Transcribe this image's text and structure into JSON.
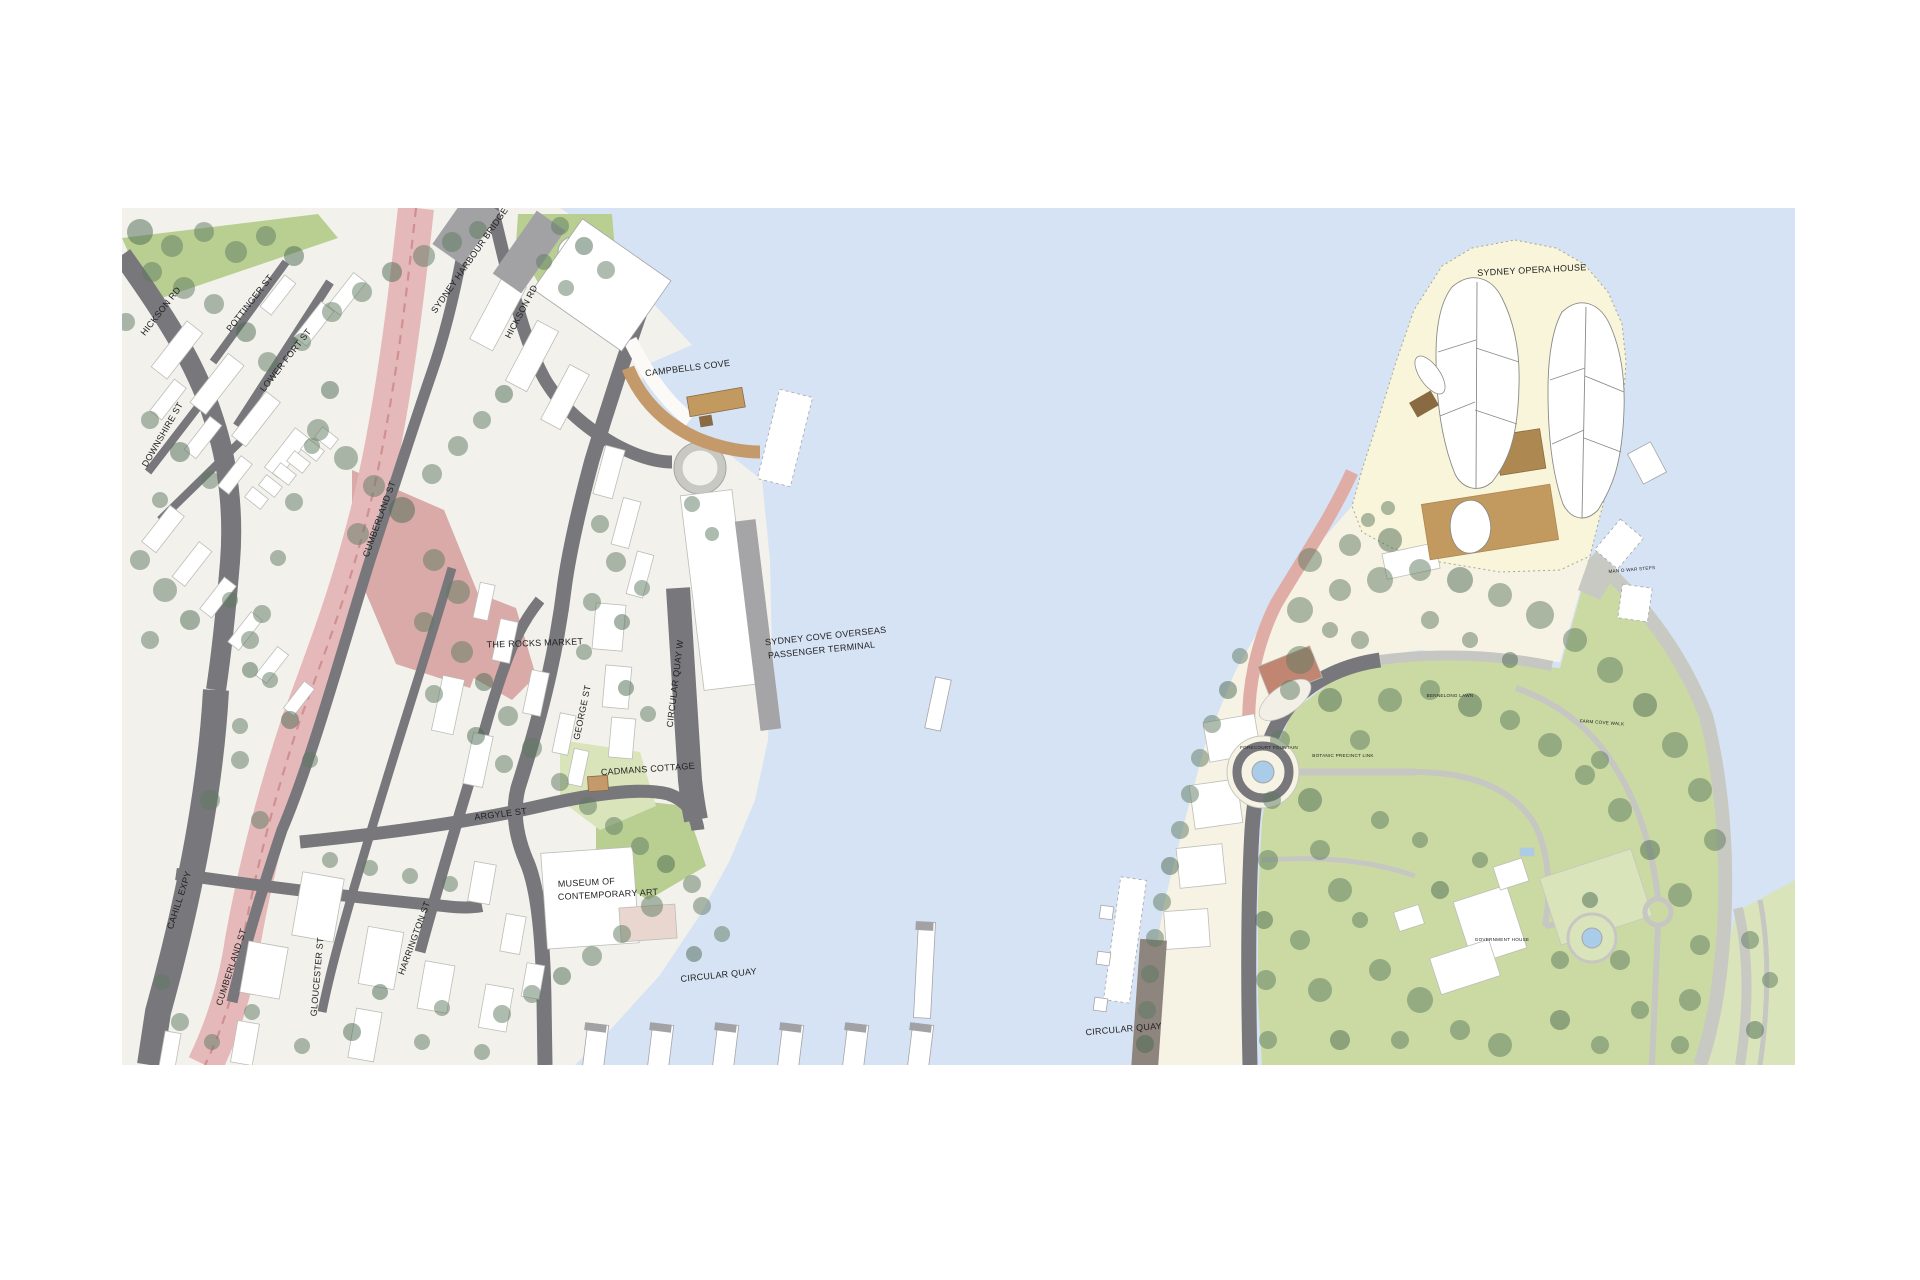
{
  "map": {
    "description_labels": "architectural site plan of Sydney Cove, Circular Quay, The Rocks and Bennelong Point"
  },
  "labels": [
    {
      "text": "SYDNEY HARBOUR BRIDGE",
      "x": 472,
      "y": 262,
      "rot": -55,
      "size": 9
    },
    {
      "text": "HICKSON RD",
      "x": 163,
      "y": 313,
      "rot": -52,
      "size": 9
    },
    {
      "text": "POTTINGER ST",
      "x": 252,
      "y": 305,
      "rot": -52,
      "size": 9
    },
    {
      "text": "LOWER FORT ST",
      "x": 288,
      "y": 362,
      "rot": -52,
      "size": 9
    },
    {
      "text": "DOWNSHIRE ST",
      "x": 165,
      "y": 436,
      "rot": -60,
      "size": 9
    },
    {
      "text": "HICKSON RD",
      "x": 524,
      "y": 313,
      "rot": -62,
      "size": 9
    },
    {
      "text": "CAMPBELLS COVE",
      "x": 688,
      "y": 371,
      "rot": -7,
      "size": 9
    },
    {
      "text": "THE ROCKS MARKET",
      "x": 535,
      "y": 646,
      "rot": -2,
      "size": 9
    },
    {
      "text": "SYDNEY COVE OVERSEAS",
      "x": 826,
      "y": 639,
      "rot": -6,
      "size": 9
    },
    {
      "text": "PASSENGER TERMINAL",
      "x": 822,
      "y": 653,
      "rot": -6,
      "size": 9
    },
    {
      "text": "CIRCULAR QUAY W",
      "x": 678,
      "y": 684,
      "rot": -83,
      "size": 9
    },
    {
      "text": "GEORGE ST",
      "x": 585,
      "y": 713,
      "rot": -78,
      "size": 9
    },
    {
      "text": "CUMBERLAND ST",
      "x": 382,
      "y": 520,
      "rot": -70,
      "size": 9
    },
    {
      "text": "CADMANS COTTAGE",
      "x": 648,
      "y": 772,
      "rot": -4,
      "size": 9
    },
    {
      "text": "ARGYLE ST",
      "x": 501,
      "y": 817,
      "rot": -7,
      "size": 9
    },
    {
      "text": "MUSEUM OF",
      "x": 558,
      "y": 887,
      "rot": -3,
      "size": 9,
      "anchor": "start"
    },
    {
      "text": "CONTEMPORARY ART",
      "x": 558,
      "y": 900,
      "rot": -3,
      "size": 9,
      "anchor": "start"
    },
    {
      "text": "CAHILL EXPY",
      "x": 182,
      "y": 901,
      "rot": -72,
      "size": 9
    },
    {
      "text": "CUMBERLAND ST",
      "x": 234,
      "y": 968,
      "rot": -72,
      "size": 9
    },
    {
      "text": "GLOUCESTER ST",
      "x": 320,
      "y": 977,
      "rot": -85,
      "size": 9
    },
    {
      "text": "HARRINGTON ST",
      "x": 417,
      "y": 939,
      "rot": -70,
      "size": 9
    },
    {
      "text": "CIRCULAR QUAY",
      "x": 719,
      "y": 978,
      "rot": -6,
      "size": 9
    },
    {
      "text": "CIRCULAR QUAY",
      "x": 1124,
      "y": 1032,
      "rot": -5,
      "size": 9
    },
    {
      "text": "SYDNEY OPERA HOUSE",
      "x": 1532,
      "y": 273,
      "rot": -3,
      "size": 9
    },
    {
      "text": "MAN O WAR STEPS",
      "x": 1632,
      "y": 571,
      "rot": -5,
      "size": 4.6
    },
    {
      "text": "BENNELONG LAWN",
      "x": 1450,
      "y": 697,
      "rot": 0,
      "size": 4.6
    },
    {
      "text": "BOTANIC PRECINCT LINK",
      "x": 1343,
      "y": 757,
      "rot": 0,
      "size": 4.6
    },
    {
      "text": "FORECOURT FOUNTAIN",
      "x": 1269,
      "y": 749,
      "rot": 0,
      "size": 4.6
    },
    {
      "text": "FARM COVE WALK",
      "x": 1602,
      "y": 724,
      "rot": 4,
      "size": 4.6
    },
    {
      "text": "GOVERNMENT HOUSE",
      "x": 1502,
      "y": 941,
      "rot": 0,
      "size": 4.6
    }
  ],
  "colors": {
    "water": "#d6e3f4",
    "land": "#f2f1ec",
    "building": "#ffffff",
    "building_stroke": "#bdbdb8",
    "road_dark": "#77777c",
    "road_mid": "#a5a5a8",
    "expressway_pink": "#e5b9ba",
    "road_red_line": "#d09090",
    "plaza_pink": "#d9aaa7",
    "boardwalk_tan": "#c59a6a",
    "podium_tan": "#c29a60",
    "podium_brown": "#ad8850",
    "podium_dark": "#8a6a42",
    "peninsula_cream": "#f8f5da",
    "promenade_cream": "#f6f3e4",
    "garden_green": "#cbdaa3",
    "lawn_light": "#d9e4ba",
    "park_green": "#b9cf92",
    "tree": "#5d7a5f",
    "tree_dark": "#4c6a52",
    "path_gray": "#c6c6c2",
    "stone": "#c9c9c3",
    "pond_blue": "#a9cce9",
    "pink_path": "#dfaca6",
    "brick": "#c08672",
    "pink_building": "#e9d6cf",
    "wharf_dark": "#8d857e",
    "pier_gray": "#a2a2a5",
    "white_soft": "#fbfaf6",
    "label": "#222222"
  }
}
